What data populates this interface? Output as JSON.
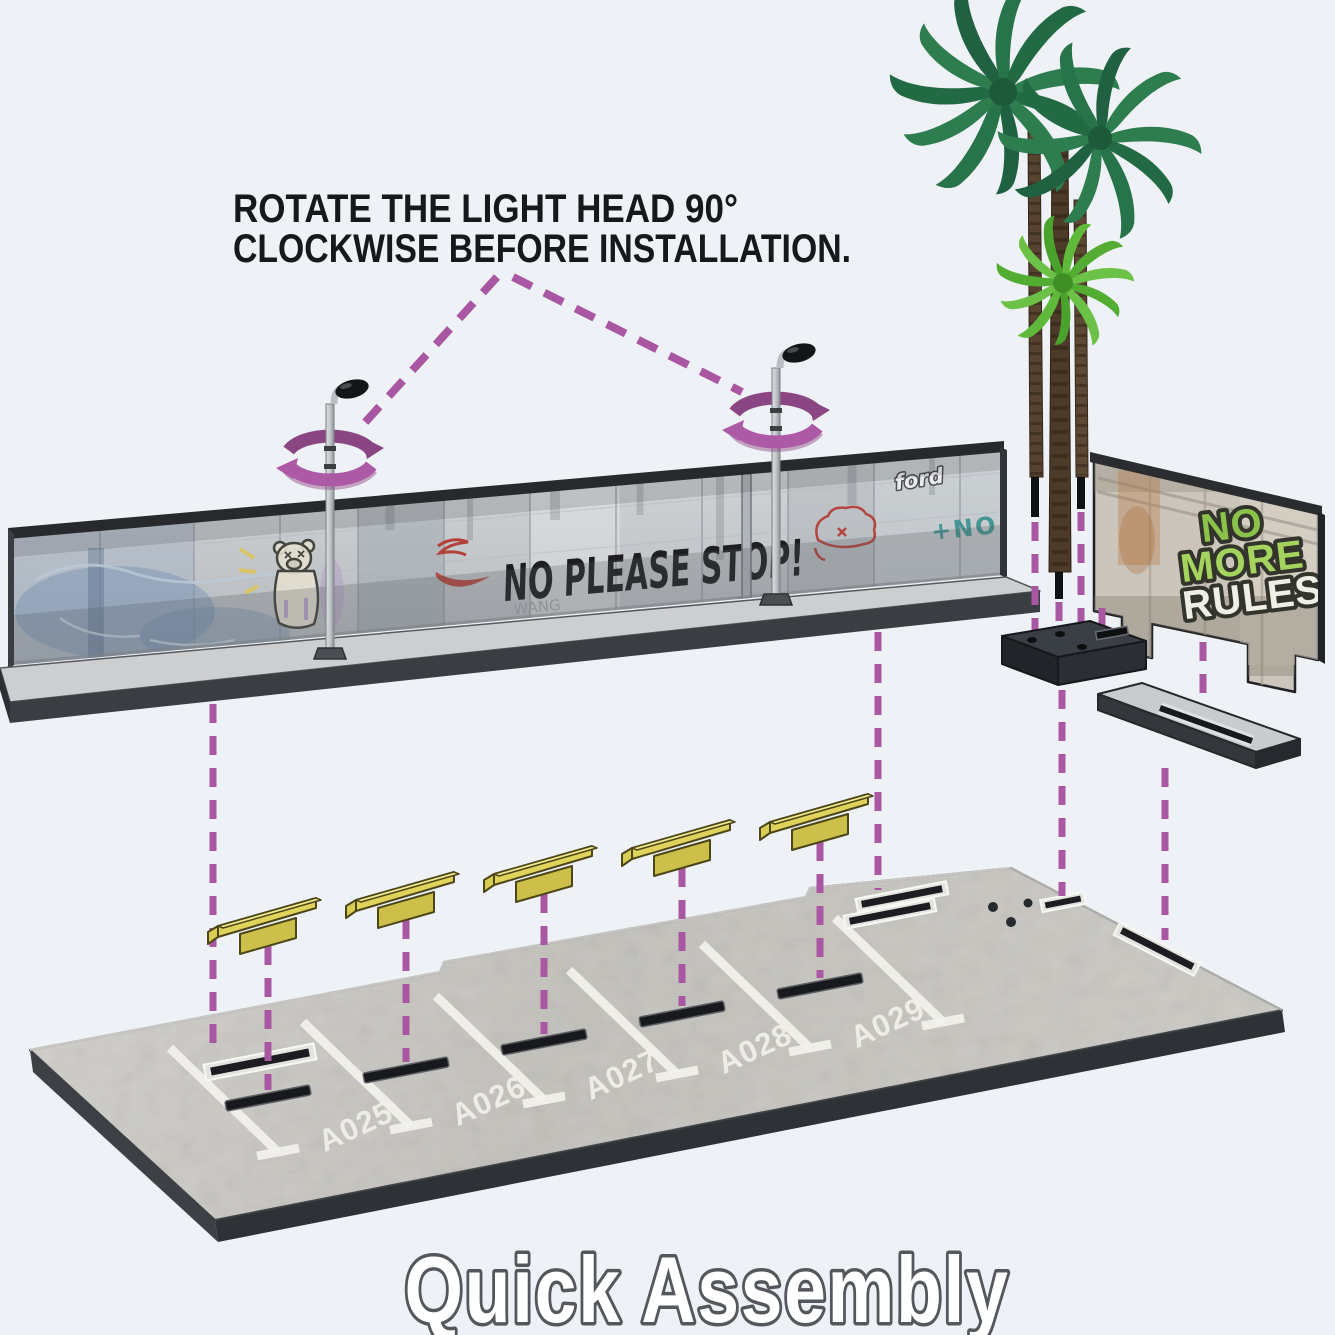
{
  "canvas": {
    "width": 1335,
    "height": 1335,
    "background": "#eef1f5"
  },
  "colors": {
    "accent_purple": "#a957a3",
    "curb_yellow": "#e9e076",
    "graffiti_green": "#8bc34a",
    "concrete_gray": "#c8c6c0",
    "palm_dark_green": "#2e7d4f",
    "palm_light_green": "#6cc246",
    "ink": "#17181a"
  },
  "instruction": {
    "line1": "ROTATE THE LIGHT HEAD 90°",
    "line2": "CLOCKWISE BEFORE INSTALLATION."
  },
  "wall": {
    "graffiti_main": "NO PLEASE STOP!",
    "tag_small": "WANG",
    "tag_ford": "ford",
    "tag_teal": "+NO"
  },
  "right_wall": {
    "graffiti_lines": [
      "NO",
      "MORE",
      "RULES"
    ]
  },
  "lot": {
    "stalls": [
      {
        "label": "A025"
      },
      {
        "label": "A026"
      },
      {
        "label": "A027"
      },
      {
        "label": "A028"
      },
      {
        "label": "A029"
      }
    ]
  },
  "footer": {
    "title": "Quick Assembly"
  }
}
